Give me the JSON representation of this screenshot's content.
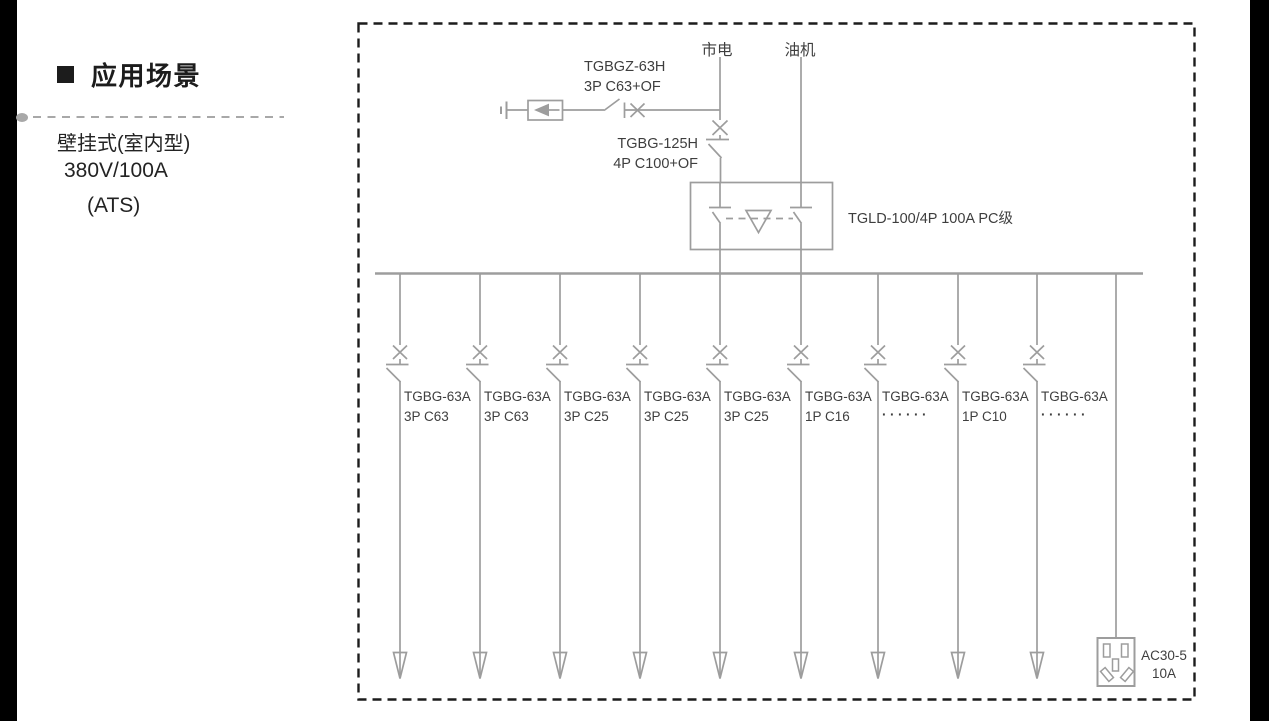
{
  "sidebar": {
    "title": "应用场景",
    "lines": [
      "壁挂式(室内型)",
      "380V/100A",
      "(ATS)"
    ]
  },
  "diagram": {
    "mains_label": "市电",
    "generator_label": "油机",
    "surge_breaker": {
      "model": "TGBGZ-63H",
      "spec": "3P C63+OF"
    },
    "main_breaker": {
      "model": "TGBG-125H",
      "spec": "4P C100+OF"
    },
    "ats_label": "TGLD-100/4P 100A PC级",
    "branches": [
      {
        "model": "TGBG-63A",
        "spec": "3P C63"
      },
      {
        "model": "TGBG-63A",
        "spec": "3P C63"
      },
      {
        "model": "TGBG-63A",
        "spec": "3P C25"
      },
      {
        "model": "TGBG-63A",
        "spec": "3P C25"
      },
      {
        "model": "TGBG-63A",
        "spec": "3P C25"
      },
      {
        "model": "TGBG-63A",
        "spec": "1P C16"
      },
      {
        "model": "TGBG-63A",
        "spec": "······"
      },
      {
        "model": "TGBG-63A",
        "spec": "1P C10"
      },
      {
        "model": "TGBG-63A",
        "spec": "······"
      }
    ],
    "socket": {
      "model": "AC30-5",
      "rating": "10A"
    }
  },
  "colors": {
    "line": "#9d9d9d",
    "label": "#3e3e3e",
    "border": "#1c1c1c",
    "sidebar_text": "#1c1c1c",
    "accent_dot": "#a8a8a8"
  }
}
